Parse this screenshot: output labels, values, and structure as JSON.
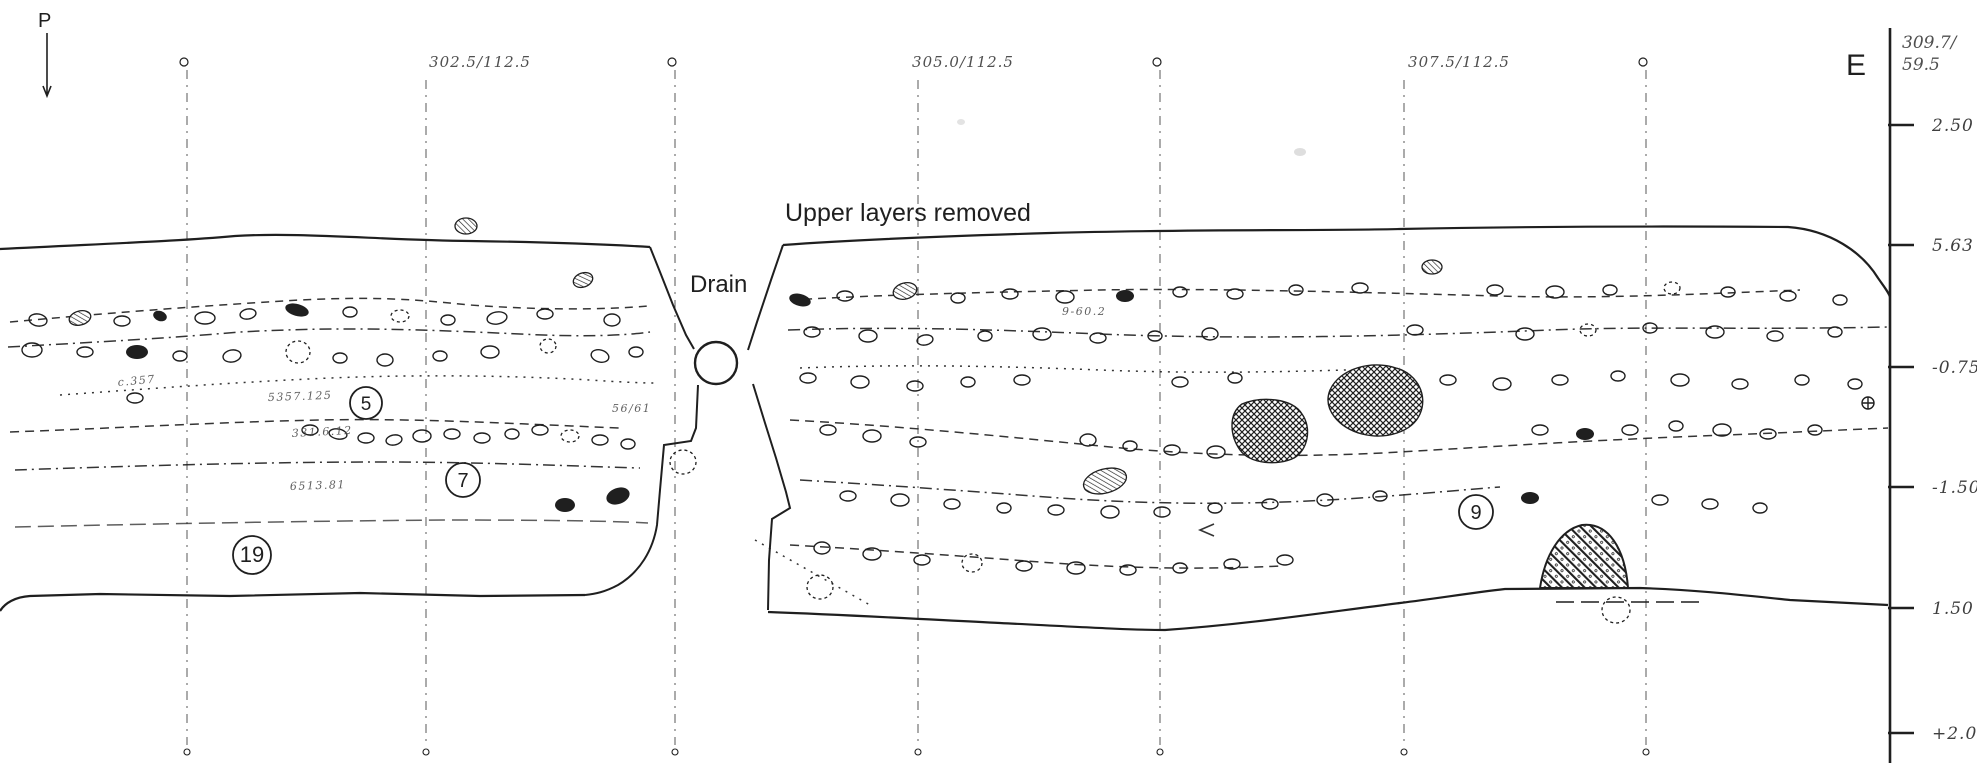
{
  "labels": {
    "profile_marker": "P",
    "section_letter": "E",
    "upper_layers": "Upper layers removed",
    "drain": "Drain"
  },
  "colors": {
    "ink": "#1f1f1f",
    "handwriting": "#4f4f4f",
    "paper": "#ffffff",
    "faint": "#c8c8c8"
  },
  "grid": {
    "vertical_lines_x": [
      187,
      426,
      675,
      918,
      1160,
      1404,
      1646
    ],
    "top_circle_marks_x": [
      187,
      675,
      1160,
      1646
    ],
    "coordinate_labels": [
      {
        "text": "302.5/112.5",
        "x": 480,
        "y": 67
      },
      {
        "text": "305.0/112.5",
        "x": 963,
        "y": 67
      },
      {
        "text": "307.5/112.5",
        "x": 1459,
        "y": 67
      }
    ]
  },
  "scale": {
    "x": 1890,
    "top_label_line1": "309.7/",
    "top_label_line2": "59.5",
    "ticks": [
      {
        "y": 125,
        "label": "2.50"
      },
      {
        "y": 245,
        "label": "5.63"
      },
      {
        "y": 367,
        "label": "-0.75"
      },
      {
        "y": 487,
        "label": "-1.50"
      },
      {
        "y": 608,
        "label": "1.50"
      },
      {
        "y": 733,
        "label": "+2.00"
      }
    ]
  },
  "layer_numbers": [
    {
      "n": "5",
      "x": 366,
      "y": 403,
      "r": 16
    },
    {
      "n": "7",
      "x": 463,
      "y": 480,
      "r": 17
    },
    {
      "n": "19",
      "x": 252,
      "y": 555,
      "r": 19
    },
    {
      "n": "9",
      "x": 1476,
      "y": 512,
      "r": 17
    }
  ],
  "find_annotations": [
    {
      "text": "5357.125",
      "x": 268,
      "y": 401,
      "rot": -2
    },
    {
      "text": "331.6.12",
      "x": 292,
      "y": 437,
      "rot": -3
    },
    {
      "text": "6513.81",
      "x": 290,
      "y": 490,
      "rot": -2
    },
    {
      "text": "c.357",
      "x": 118,
      "y": 386,
      "rot": -5
    },
    {
      "text": "56/61",
      "x": 612,
      "y": 412,
      "rot": 0
    },
    {
      "text": "9-60.2",
      "x": 1062,
      "y": 315,
      "rot": 0
    }
  ],
  "drain_pipe": {
    "cx": 716,
    "cy": 363,
    "r": 21
  },
  "stones": [
    [
      38,
      320,
      9,
      6,
      10,
      0
    ],
    [
      80,
      318,
      11,
      7,
      -15,
      3
    ],
    [
      122,
      321,
      8,
      5,
      0,
      0
    ],
    [
      160,
      316,
      7,
      5,
      20,
      2
    ],
    [
      205,
      318,
      10,
      6,
      0,
      0
    ],
    [
      248,
      314,
      8,
      5,
      -10,
      0
    ],
    [
      297,
      310,
      12,
      6,
      15,
      2
    ],
    [
      350,
      312,
      7,
      5,
      0,
      0
    ],
    [
      400,
      316,
      9,
      6,
      0,
      1
    ],
    [
      448,
      320,
      7,
      5,
      0,
      0
    ],
    [
      497,
      318,
      10,
      6,
      -10,
      0
    ],
    [
      545,
      314,
      8,
      5,
      0,
      0
    ],
    [
      583,
      280,
      10,
      7,
      -20,
      3
    ],
    [
      612,
      320,
      8,
      6,
      0,
      0
    ],
    [
      466,
      226,
      11,
      8,
      0,
      3
    ],
    [
      32,
      350,
      10,
      7,
      0,
      0
    ],
    [
      85,
      352,
      8,
      5,
      0,
      0
    ],
    [
      137,
      352,
      11,
      7,
      0,
      2
    ],
    [
      180,
      356,
      7,
      5,
      0,
      0
    ],
    [
      232,
      356,
      9,
      6,
      -10,
      0
    ],
    [
      298,
      352,
      12,
      11,
      0,
      1
    ],
    [
      340,
      358,
      7,
      5,
      0,
      0
    ],
    [
      385,
      360,
      8,
      6,
      0,
      0
    ],
    [
      440,
      356,
      7,
      5,
      0,
      0
    ],
    [
      490,
      352,
      9,
      6,
      0,
      0
    ],
    [
      548,
      346,
      8,
      7,
      0,
      1
    ],
    [
      600,
      356,
      9,
      6,
      15,
      0
    ],
    [
      636,
      352,
      7,
      5,
      0,
      0
    ],
    [
      135,
      398,
      8,
      5,
      0,
      0
    ],
    [
      310,
      430,
      8,
      5,
      0,
      0
    ],
    [
      338,
      434,
      9,
      5,
      10,
      0
    ],
    [
      366,
      438,
      8,
      5,
      0,
      0
    ],
    [
      394,
      440,
      8,
      5,
      -10,
      0
    ],
    [
      422,
      436,
      9,
      6,
      0,
      0
    ],
    [
      452,
      434,
      8,
      5,
      0,
      0
    ],
    [
      482,
      438,
      8,
      5,
      0,
      0
    ],
    [
      512,
      434,
      7,
      5,
      0,
      0
    ],
    [
      540,
      430,
      8,
      5,
      0,
      0
    ],
    [
      570,
      436,
      9,
      6,
      0,
      1
    ],
    [
      600,
      440,
      8,
      5,
      0,
      0
    ],
    [
      628,
      444,
      7,
      5,
      0,
      0
    ],
    [
      565,
      505,
      10,
      7,
      0,
      2
    ],
    [
      618,
      496,
      12,
      8,
      -20,
      2
    ],
    [
      683,
      462,
      13,
      12,
      0,
      1
    ],
    [
      800,
      300,
      11,
      6,
      15,
      2
    ],
    [
      845,
      296,
      8,
      5,
      0,
      0
    ],
    [
      905,
      291,
      12,
      8,
      -15,
      3
    ],
    [
      958,
      298,
      7,
      5,
      0,
      0
    ],
    [
      1010,
      294,
      8,
      5,
      0,
      0
    ],
    [
      1065,
      297,
      9,
      6,
      0,
      0
    ],
    [
      1125,
      296,
      9,
      6,
      0,
      2
    ],
    [
      1180,
      292,
      7,
      5,
      0,
      0
    ],
    [
      1235,
      294,
      8,
      5,
      0,
      0
    ],
    [
      1296,
      290,
      7,
      5,
      0,
      0
    ],
    [
      1360,
      288,
      8,
      5,
      0,
      0
    ],
    [
      1432,
      267,
      10,
      7,
      0,
      3
    ],
    [
      1495,
      290,
      8,
      5,
      0,
      0
    ],
    [
      1555,
      292,
      9,
      6,
      0,
      0
    ],
    [
      1610,
      290,
      7,
      5,
      0,
      0
    ],
    [
      1672,
      288,
      8,
      6,
      0,
      1
    ],
    [
      1728,
      292,
      7,
      5,
      0,
      0
    ],
    [
      1788,
      296,
      8,
      5,
      0,
      0
    ],
    [
      1840,
      300,
      7,
      5,
      0,
      0
    ],
    [
      812,
      332,
      8,
      5,
      0,
      0
    ],
    [
      868,
      336,
      9,
      6,
      0,
      0
    ],
    [
      925,
      340,
      8,
      5,
      -10,
      0
    ],
    [
      985,
      336,
      7,
      5,
      0,
      0
    ],
    [
      1042,
      334,
      9,
      6,
      0,
      0
    ],
    [
      1098,
      338,
      8,
      5,
      0,
      0
    ],
    [
      1155,
      336,
      7,
      5,
      0,
      0
    ],
    [
      1210,
      334,
      8,
      6,
      0,
      0
    ],
    [
      1415,
      330,
      8,
      5,
      0,
      0
    ],
    [
      1525,
      334,
      9,
      6,
      0,
      0
    ],
    [
      1588,
      330,
      8,
      6,
      0,
      1
    ],
    [
      1650,
      328,
      7,
      5,
      0,
      0
    ],
    [
      1715,
      332,
      9,
      6,
      0,
      0
    ],
    [
      1775,
      336,
      8,
      5,
      0,
      0
    ],
    [
      1835,
      332,
      7,
      5,
      0,
      0
    ],
    [
      808,
      378,
      8,
      5,
      0,
      0
    ],
    [
      860,
      382,
      9,
      6,
      0,
      0
    ],
    [
      915,
      386,
      8,
      5,
      0,
      0
    ],
    [
      968,
      382,
      7,
      5,
      0,
      0
    ],
    [
      1022,
      380,
      8,
      5,
      0,
      0
    ],
    [
      1180,
      382,
      8,
      5,
      0,
      0
    ],
    [
      1235,
      378,
      7,
      5,
      0,
      0
    ],
    [
      1448,
      380,
      8,
      5,
      0,
      0
    ],
    [
      1502,
      384,
      9,
      6,
      0,
      0
    ],
    [
      1560,
      380,
      8,
      5,
      0,
      0
    ],
    [
      1618,
      376,
      7,
      5,
      0,
      0
    ],
    [
      1680,
      380,
      9,
      6,
      0,
      0
    ],
    [
      1740,
      384,
      8,
      5,
      0,
      0
    ],
    [
      1802,
      380,
      7,
      5,
      0,
      0
    ],
    [
      1855,
      384,
      7,
      5,
      0,
      0
    ],
    [
      1105,
      481,
      22,
      12,
      -15,
      3
    ],
    [
      828,
      430,
      8,
      5,
      0,
      0
    ],
    [
      872,
      436,
      9,
      6,
      0,
      0
    ],
    [
      918,
      442,
      8,
      5,
      0,
      0
    ],
    [
      1088,
      440,
      8,
      6,
      0,
      0
    ],
    [
      1130,
      446,
      7,
      5,
      0,
      0
    ],
    [
      1172,
      450,
      8,
      5,
      0,
      0
    ],
    [
      1216,
      452,
      9,
      6,
      0,
      0
    ],
    [
      1540,
      430,
      8,
      5,
      0,
      0
    ],
    [
      1585,
      434,
      9,
      6,
      0,
      2
    ],
    [
      1630,
      430,
      8,
      5,
      0,
      0
    ],
    [
      1676,
      426,
      7,
      5,
      0,
      0
    ],
    [
      1722,
      430,
      9,
      6,
      0,
      0
    ],
    [
      1768,
      434,
      8,
      5,
      0,
      0
    ],
    [
      1815,
      430,
      7,
      5,
      0,
      0
    ],
    [
      848,
      496,
      8,
      5,
      0,
      0
    ],
    [
      900,
      500,
      9,
      6,
      0,
      0
    ],
    [
      952,
      504,
      8,
      5,
      0,
      0
    ],
    [
      1004,
      508,
      7,
      5,
      0,
      0
    ],
    [
      1056,
      510,
      8,
      5,
      0,
      0
    ],
    [
      1110,
      512,
      9,
      6,
      0,
      0
    ],
    [
      1162,
      512,
      8,
      5,
      0,
      0
    ],
    [
      1215,
      508,
      7,
      5,
      0,
      0
    ],
    [
      1270,
      504,
      8,
      5,
      0,
      0
    ],
    [
      1325,
      500,
      8,
      6,
      0,
      0
    ],
    [
      1380,
      496,
      7,
      5,
      0,
      0
    ],
    [
      1530,
      498,
      9,
      6,
      0,
      2
    ],
    [
      1660,
      500,
      8,
      5,
      0,
      0
    ],
    [
      1710,
      504,
      8,
      5,
      0,
      0
    ],
    [
      1760,
      508,
      7,
      5,
      0,
      0
    ],
    [
      822,
      548,
      8,
      6,
      0,
      0
    ],
    [
      872,
      554,
      9,
      6,
      0,
      0
    ],
    [
      922,
      560,
      8,
      5,
      0,
      0
    ],
    [
      972,
      563,
      10,
      9,
      0,
      1
    ],
    [
      1024,
      566,
      8,
      5,
      0,
      0
    ],
    [
      1076,
      568,
      9,
      6,
      0,
      0
    ],
    [
      1128,
      570,
      8,
      5,
      0,
      0
    ],
    [
      1180,
      568,
      7,
      5,
      0,
      0
    ],
    [
      1232,
      564,
      8,
      5,
      0,
      0
    ],
    [
      1285,
      560,
      8,
      5,
      0,
      0
    ],
    [
      1616,
      610,
      14,
      13,
      0,
      1
    ],
    [
      820,
      587,
      13,
      12,
      0,
      1
    ]
  ]
}
